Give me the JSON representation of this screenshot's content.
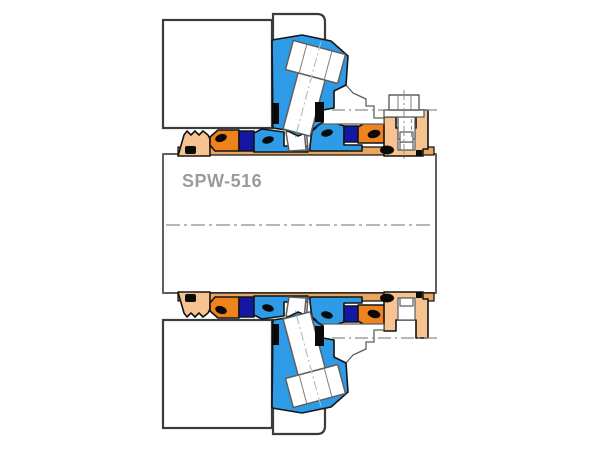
{
  "diagram": {
    "label": "SPW-516"
  },
  "colors": {
    "background": "#ffffff",
    "component_blue": "#2d9be5",
    "component_navy": "#1417a3",
    "component_orange": "#f0821d",
    "component_peach": "#f7c391",
    "sleeve_tan": "#e9a65c",
    "oring_black": "#0a0a0a",
    "outline_dark": "#141414",
    "outline_gray": "#5f5f5f",
    "box_outline": "#3c3c3c",
    "centerline_gray": "#8c8c8c",
    "bolt_axis_teal": "#9fc3bc",
    "label_gray": "#9b9b9b"
  }
}
